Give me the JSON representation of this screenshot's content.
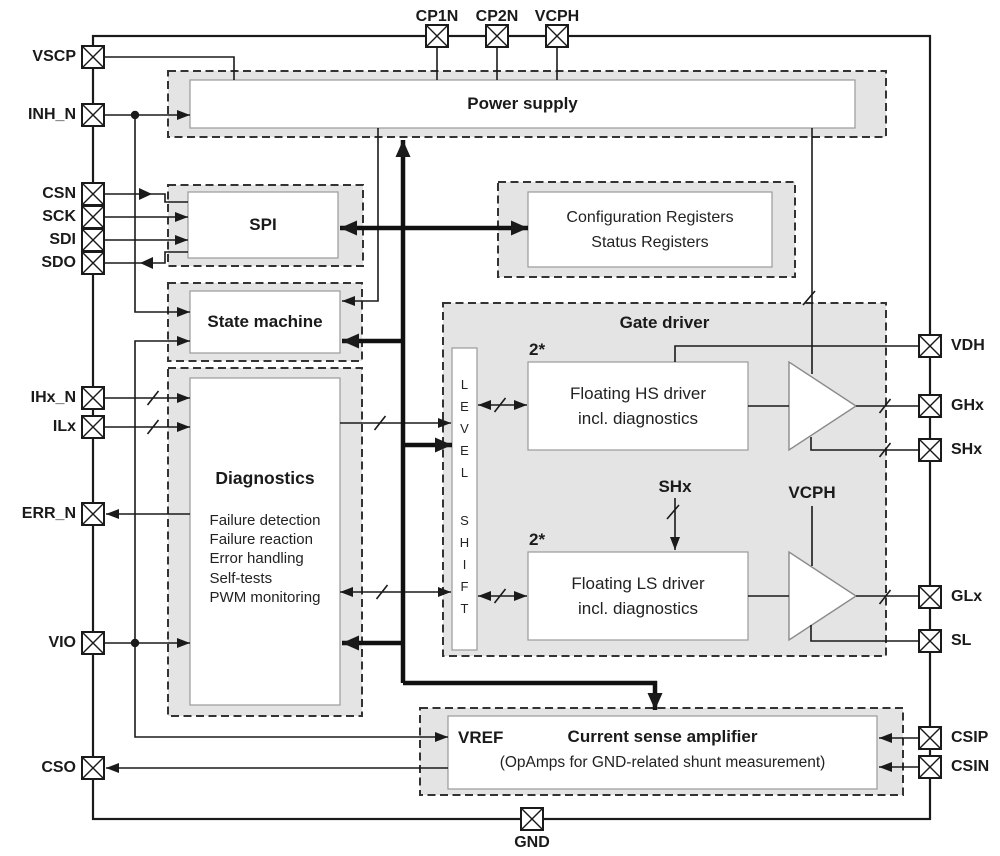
{
  "title": "Gate driver IC block diagram",
  "colors": {
    "line": "#1a1a1a",
    "container_fill": "#e4e4e4",
    "dashed_border": "#333333",
    "inner_border": "#9a9a9a",
    "background": "#ffffff"
  },
  "pins": {
    "top": [
      "CP1N",
      "CP2N",
      "VCPH"
    ],
    "left": [
      "VSCP",
      "INH_N",
      "CSN",
      "SCK",
      "SDI",
      "SDO",
      "IHx_N",
      "ILx",
      "ERR_N",
      "VIO",
      "CSO"
    ],
    "right": [
      "VDH",
      "GHx",
      "SHx",
      "GLx",
      "SL",
      "CSIP",
      "CSIN"
    ],
    "bottom": [
      "GND"
    ]
  },
  "blocks": {
    "power_supply": {
      "title": "Power supply"
    },
    "spi": {
      "title": "SPI"
    },
    "registers": {
      "line1": "Configuration Registers",
      "line2": "Status Registers"
    },
    "state_machine": {
      "title": "State machine"
    },
    "diagnostics": {
      "title": "Diagnostics",
      "items": [
        "Failure detection",
        "Failure reaction",
        "Error handling",
        "Self-tests",
        "PWM monitoring"
      ]
    },
    "gate_driver": {
      "title": "Gate driver",
      "level_shift": "LEVEL SHIFT",
      "hs_count": "2*",
      "hs_line1": "Floating HS driver",
      "hs_line2": "incl. diagnostics",
      "ls_count": "2*",
      "ls_line1": "Floating LS driver",
      "ls_line2": "incl. diagnostics",
      "shx_label": "SHx",
      "vcph_label": "VCPH"
    },
    "current_sense": {
      "vref": "VREF",
      "title": "Current sense amplifier",
      "subtitle": "(OpAmps for GND-related shunt measurement)"
    }
  }
}
